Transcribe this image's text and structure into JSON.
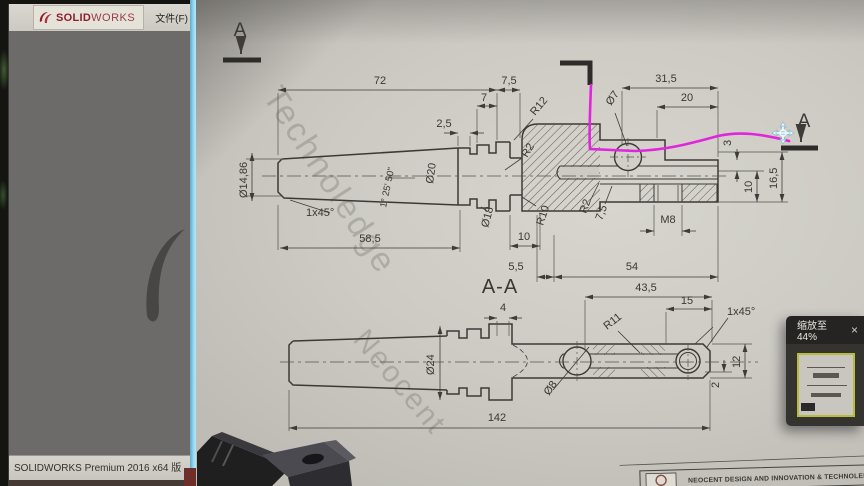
{
  "app": {
    "brand_bold": "SOLID",
    "brand_light": "WORKS",
    "menu_file": "文件(F)",
    "menu_view": "视图(V",
    "status_bar": "SOLIDWORKS Premium 2016 x64 版"
  },
  "overlay": {
    "zoom_label": "缩放至44%",
    "close": "×"
  },
  "drawing": {
    "watermark_top": "Technoledge",
    "watermark_bottom": "Neocent",
    "title_block": "NEOCENT DESIGN AND INNOVATION & TECHNOLEDGE IN",
    "section_label_left": "A",
    "section_label_right": "A",
    "view_title": "A-A"
  },
  "dims": {
    "d72": "72",
    "d7_5t": "7,5",
    "d7": "7",
    "d2_5": "2,5",
    "d31_5": "31,5",
    "d20": "20",
    "dia7": "Ø7",
    "r12": "R12",
    "dia14_86": "Ø14,86",
    "chamfer1": "1x45°",
    "dia20": "Ø20",
    "taper": "1° 25' 50\"",
    "dia18": "Ø18",
    "d58_5": "58,5",
    "r10": "R10",
    "d10btm": "10",
    "r2a": "R2",
    "r2b": "R2",
    "d7_5s": "7,5",
    "d5_5": "5,5",
    "d54": "54",
    "m8": "M8",
    "d3": "3",
    "d10r": "10",
    "d16_5": "16,5",
    "d4": "4",
    "d43_5": "43,5",
    "d15": "15",
    "chamfer2": "1x45°",
    "r11": "R11",
    "dia24": "Ø24",
    "dia8": "Ø8",
    "d12": "12",
    "d2": "2",
    "d142": "142"
  },
  "colors": {
    "annotation_magenta": "#e125dd",
    "viewer_edge_blue": "#9adcf5",
    "brand_red": "#8e1f2c",
    "thumb_border_yellow": "#b9bb40"
  }
}
